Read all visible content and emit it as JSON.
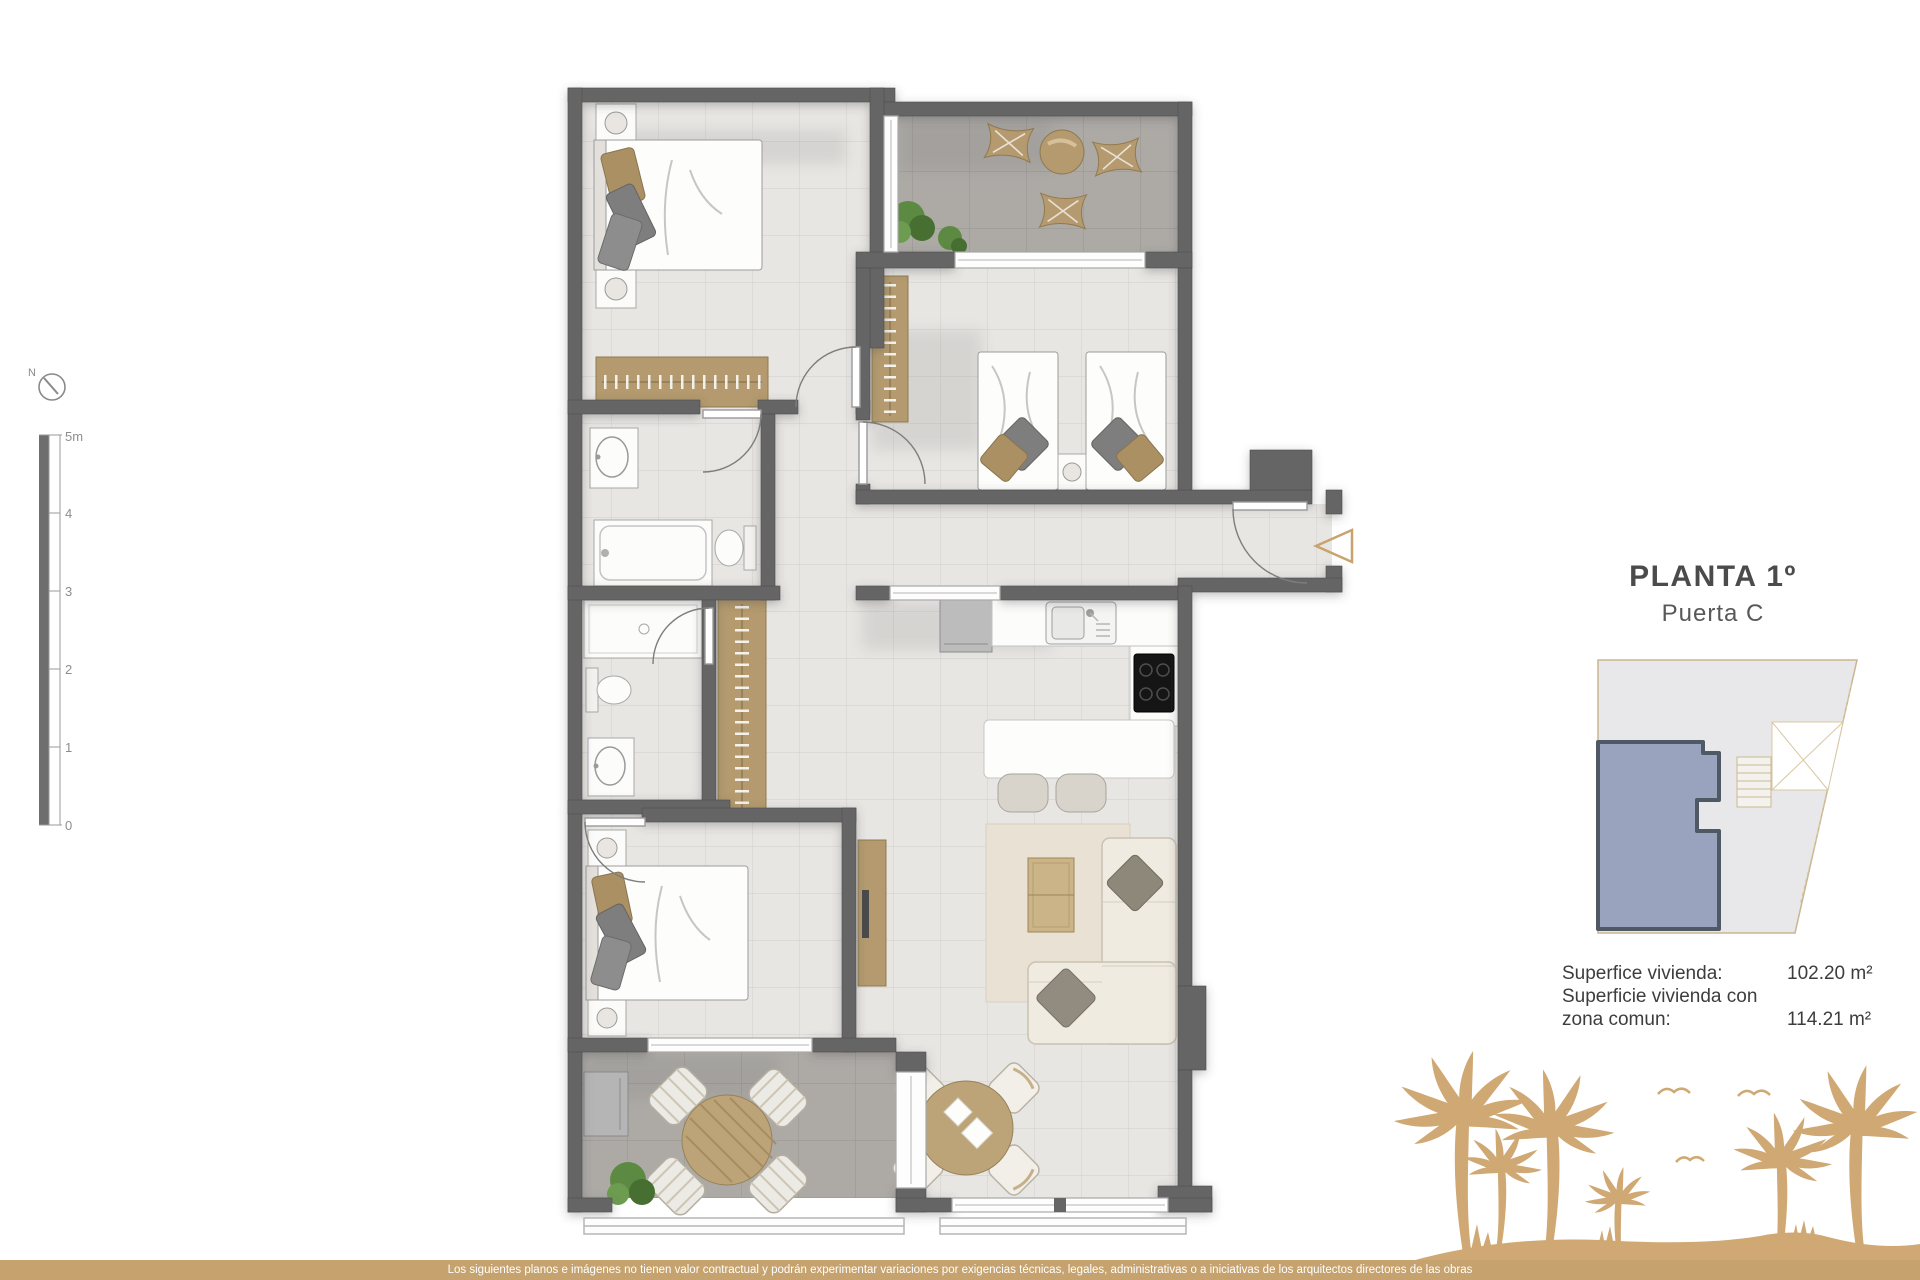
{
  "header": {
    "title": "PLANTA 1º",
    "subtitle": "Puerta C"
  },
  "area_info": {
    "rows": [
      {
        "label": "Superfice vivienda:",
        "value": "102.20 m²"
      },
      {
        "label": "Superficie vivienda con",
        "value": ""
      },
      {
        "label": "zona comun:",
        "value": "114.21 m²"
      }
    ]
  },
  "scale_bar": {
    "labels": [
      "5m",
      "4",
      "3",
      "2",
      "1",
      "0"
    ]
  },
  "compass": {
    "north_label": "N"
  },
  "footer": {
    "disclaimer": "Los siguientes planos e imágenes no tienen valor contractual y podrán experimentar variaciones por exigencias técnicas, legales, administrativas o a iniciativas de los arquitectos directores de las obras"
  },
  "colors": {
    "accent_gold": "#c9a36e",
    "palm_tan": "#cfa873",
    "footer_tan": "#c5a26e",
    "wall_gray": "#656565",
    "floor_light": "#e8e6e3",
    "terrace_gray": "#adaaa6",
    "wood_tan": "#b49a6e",
    "unit_highlight_fill": "#9aa3bd",
    "unit_highlight_stroke": "#4f5865"
  }
}
